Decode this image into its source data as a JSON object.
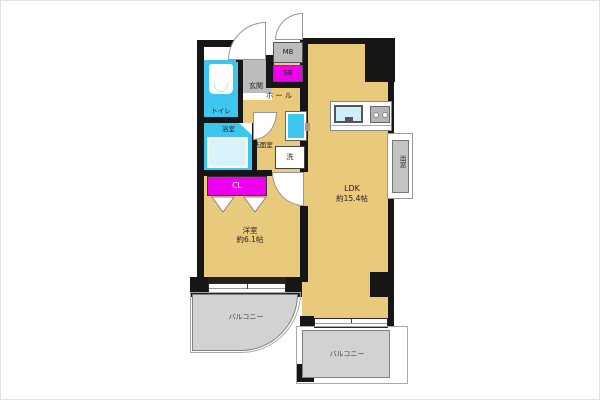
{
  "floorplan": {
    "title": "1LDK apartment floor plan",
    "colors": {
      "floor": "#e9c97b",
      "wet_area": "#3ec6ef",
      "bathtub": "#d9f3fb",
      "closet_magenta": "#ee00ee",
      "fixture_gray": "#bcbcbc",
      "balcony_gray": "#d2d2d2",
      "wall_black": "#161616",
      "background": "#ffffff"
    },
    "labels": {
      "entrance": "玄関",
      "toilet": "トイレ",
      "hall": "ホール",
      "meter_box": "MB",
      "shoe_box": "SB",
      "bath": "浴室",
      "washroom": "洗面室",
      "washer": "洗",
      "closet": "CL",
      "bedroom": "洋室",
      "bedroom_size": "約6.1帖",
      "ldk": "LDK",
      "ldk_size": "約15.4帖",
      "balcony_left": "バルコニー",
      "balcony_right": "バルコニー",
      "bay_window": "出窓"
    }
  }
}
